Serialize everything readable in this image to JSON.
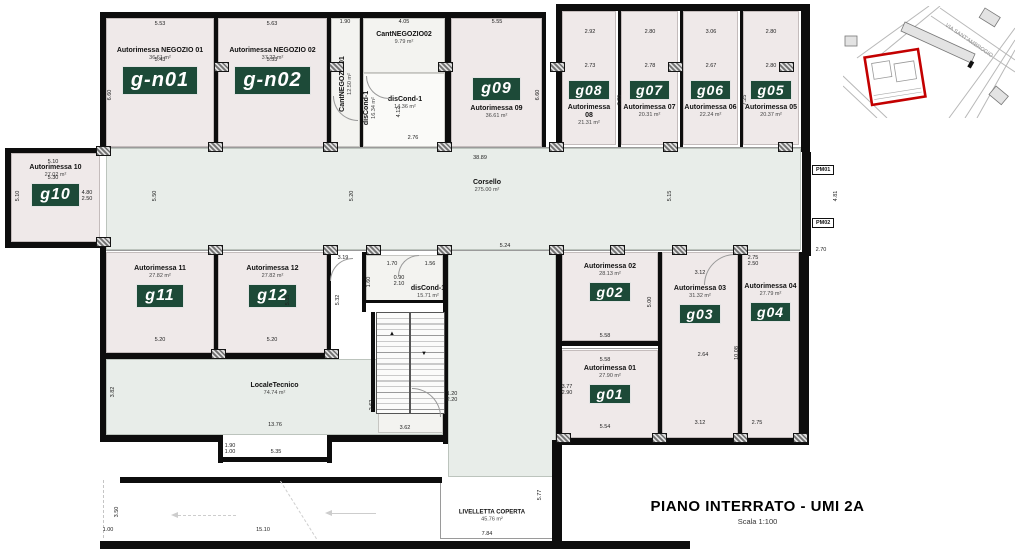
{
  "title": {
    "main": "PIANO INTERRATO - UMI 2A",
    "scale": "Scala 1:100"
  },
  "inset": {
    "street": "VIA SANT'AMBROGIO"
  },
  "pm": {
    "pm01": "PM01",
    "pm02": "PM02"
  },
  "rooms": {
    "gn01": {
      "tag": "g-n01",
      "name": "Autorimessa NEGOZIO 01",
      "area": "36.61 m²"
    },
    "gn02": {
      "tag": "g-n02",
      "name": "Autorimessa NEGOZIO 02",
      "area": "37.22 m²"
    },
    "cant01": {
      "name": "CantNEGOZIO01",
      "area": "12.50 m²"
    },
    "cant02": {
      "name": "CantNEGOZIO02",
      "area": "9.79 m²"
    },
    "discond_v": {
      "name": "disCond-1",
      "area": "16.34 m²"
    },
    "discond_top": {
      "name": "disCond-1",
      "area": "14.36 m²"
    },
    "discond_mid": {
      "name": "disCond-1",
      "area": "15.71 m²"
    },
    "g09": {
      "tag": "g09",
      "name": "Autorimessa 09",
      "area": "36.61 m²"
    },
    "g08": {
      "tag": "g08",
      "name": "Autorimessa 08",
      "area": "21.31 m²"
    },
    "g07": {
      "tag": "g07",
      "name": "Autorimessa 07",
      "area": "20.31 m²"
    },
    "g06": {
      "tag": "g06",
      "name": "Autorimessa 06",
      "area": "22.24 m²"
    },
    "g05": {
      "tag": "g05",
      "name": "Autorimessa 05",
      "area": "20.37 m²"
    },
    "g10": {
      "tag": "g10",
      "name": "Autorimessa 10",
      "area": "27.02 m²"
    },
    "g11": {
      "tag": "g11",
      "name": "Autorimessa 11",
      "area": "27.82 m²"
    },
    "g12": {
      "tag": "g12",
      "name": "Autorimessa 12",
      "area": "27.82 m²"
    },
    "g02": {
      "tag": "g02",
      "name": "Autorimessa 02",
      "area": "28.13 m²"
    },
    "g03": {
      "tag": "g03",
      "name": "Autorimessa 03",
      "area": "31.32 m²"
    },
    "g04": {
      "tag": "g04",
      "name": "Autorimessa 04",
      "area": "27.79 m²"
    },
    "g01": {
      "tag": "g01",
      "name": "Autorimessa 01",
      "area": "27.90 m²"
    },
    "corsello": {
      "name": "Corsello",
      "area": "275.00 m²"
    },
    "locale_tecnico": {
      "name": "LocaleTecnico",
      "area": "74.74 m²"
    },
    "locale_bici": {
      "name": "LocaleBici",
      "area": "9.47 m²"
    },
    "livelletta": {
      "name": "LIVELLETTA COPERTA",
      "area": "45.76 m²"
    }
  },
  "dims": [
    "5.53",
    "5.63",
    "1.90",
    "4.05",
    "5.55",
    "5.43",
    "5.53",
    "2.92",
    "2.80",
    "3.06",
    "2.80",
    "2.73",
    "2.78",
    "2.67",
    "2.80",
    "6.60",
    "6.60",
    "7.25",
    "7.25",
    "4.12",
    "2.76",
    "38.89",
    "5.10",
    "5.30",
    "5.10",
    "4.80\n2.50",
    "4.81",
    "2.70",
    "5.50",
    "5.20",
    "5.15",
    "5.24",
    "5.20",
    "5.20",
    "5.35",
    "5.32",
    "3.19",
    "1.70",
    "1.56",
    "1.60",
    "0.90\n2.10",
    "3.12",
    "5.58",
    "5.58",
    "2.64",
    "10.08",
    "3.77\n2.90",
    "5.54",
    "5.00",
    "13.76",
    "3.82",
    "2.62",
    "3.62",
    "1.20\n2.20",
    "5.35",
    "1.90\n1.00",
    "15.10",
    "1.00",
    "3.50",
    "5.77",
    "7.84",
    "3.12",
    "2.75",
    "2.75\n2.50"
  ]
}
